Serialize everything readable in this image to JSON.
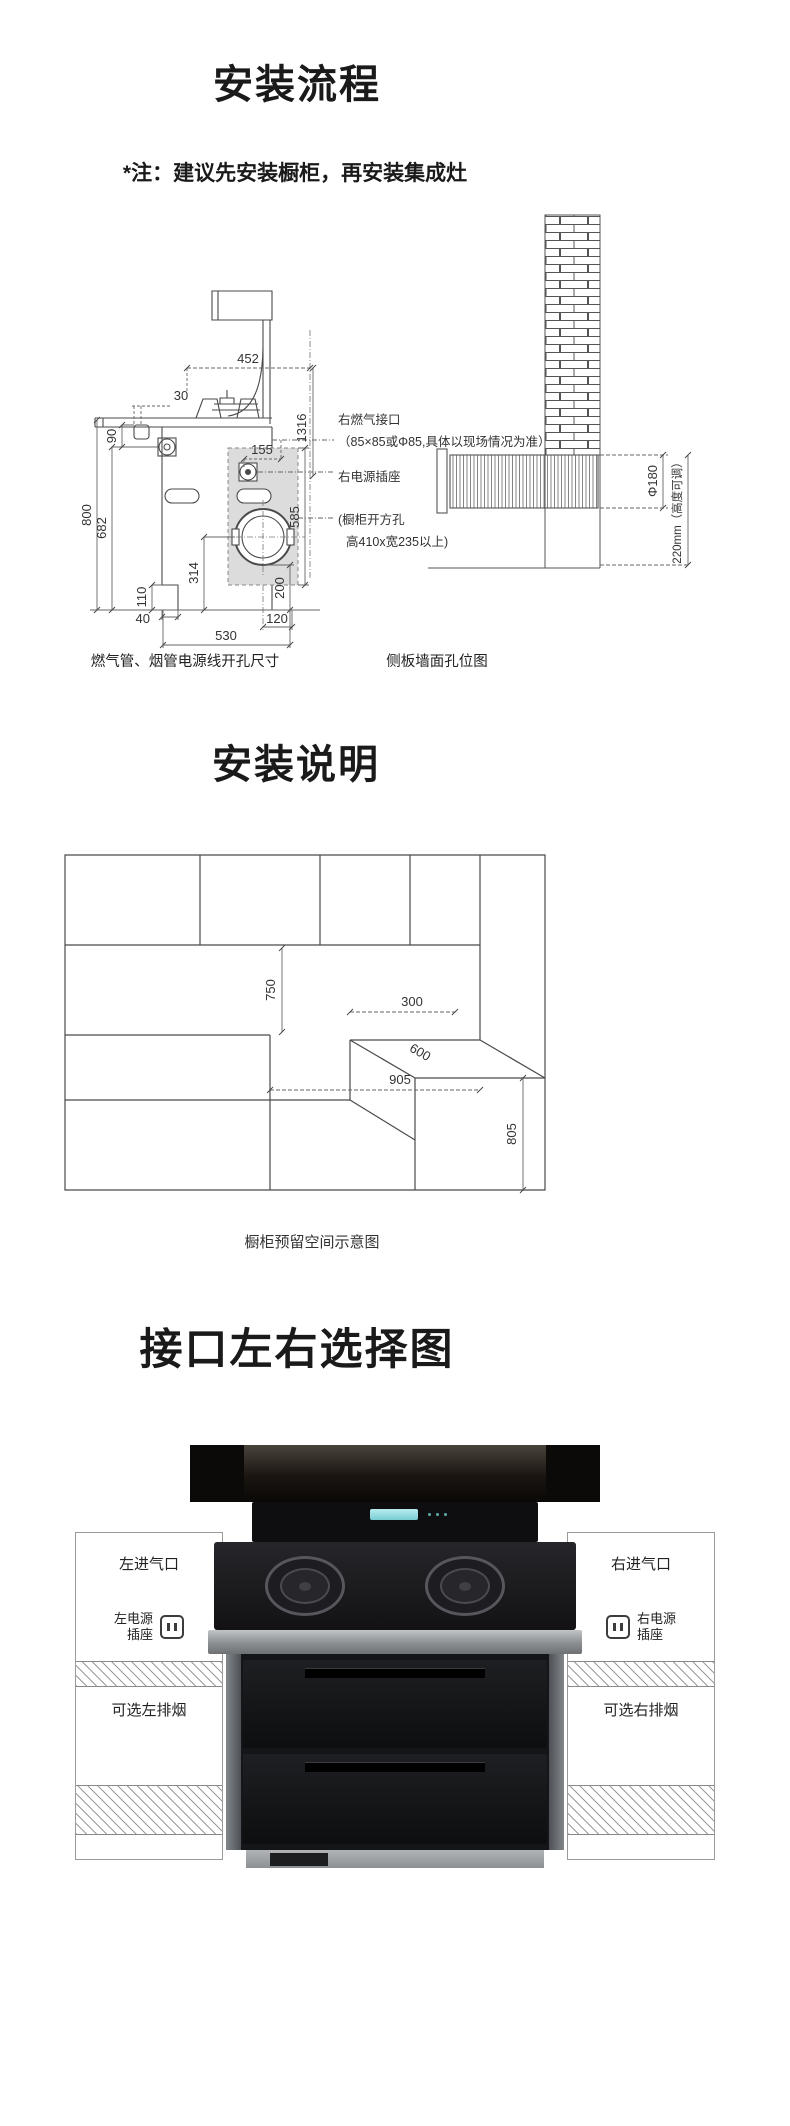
{
  "page": {
    "background": "#ffffff"
  },
  "process": {
    "title": "安装流程",
    "note": "*注：建议先安装橱柜，再安装集成灶",
    "hole_diagram": {
      "caption": "燃气管、烟管电源线开孔尺寸",
      "dims": {
        "d452": "452",
        "d30": "30",
        "d90": "90",
        "d155": "155",
        "d1316": "1316",
        "d585": "585",
        "d314": "314",
        "d200": "200",
        "d120": "120",
        "d530": "530",
        "d40": "40",
        "d110": "110",
        "d682": "682",
        "d800": "800"
      },
      "ann": {
        "gas": "右燃气接口",
        "gas_spec": "（85×85或Φ85,具体以现场情况为准）",
        "socket": "右电源插座",
        "cutout1": "(橱柜开方孔",
        "cutout2": "高410x宽235以上)"
      }
    },
    "wall_diagram": {
      "caption": "侧板墙面孔位图",
      "hole": "Φ180",
      "height": "220mm（高度可调）"
    }
  },
  "clearance": {
    "title": "安装说明",
    "caption": "橱柜预留空间示意图",
    "dims": {
      "d750": "750",
      "d300": "300",
      "d600": "600",
      "d905": "905",
      "d805": "805"
    }
  },
  "interface": {
    "title": "接口左右选择图",
    "left": {
      "inlet": "左进气口",
      "power_line1": "左电源",
      "power_line2": "插座",
      "vent": "可选左排烟"
    },
    "right": {
      "inlet": "右进气口",
      "power_line1": "右电源",
      "power_line2": "插座",
      "vent": "可选右排烟"
    }
  }
}
